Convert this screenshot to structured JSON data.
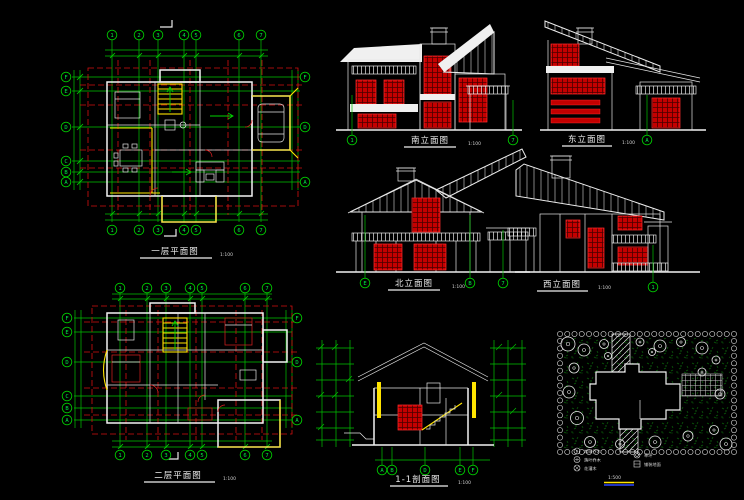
{
  "drawing": {
    "background": "#000000",
    "palette": {
      "grid_green": "#00cc00",
      "bubble_green": "#00ee44",
      "dashed_red": "#d51111",
      "window_red": "#c80000",
      "wall_white": "#f2f2f2",
      "accent_yellow": "#ffe400",
      "vegetation_green": "#0a5a0a",
      "scalebar_blue": "#2b46ff"
    }
  },
  "plan1": {
    "title": "一层平面图",
    "scale": "1:100",
    "bubbles_top": [
      "1",
      "2",
      "3",
      "4",
      "5",
      "6",
      "7"
    ],
    "bubbles_bottom": [
      "1",
      "2",
      "3",
      "4",
      "5",
      "6",
      "7"
    ],
    "bubbles_left": [
      "F",
      "E",
      "D",
      "C",
      "B",
      "A"
    ],
    "bubbles_right": [
      "F",
      "D",
      "A"
    ]
  },
  "plan2": {
    "title": "二层平面图",
    "scale": "1:100",
    "bubbles_top": [
      "1",
      "2",
      "3",
      "4",
      "5",
      "6",
      "7"
    ],
    "bubbles_bottom": [
      "1",
      "2",
      "3",
      "4",
      "5",
      "6",
      "7"
    ],
    "bubbles_left": [
      "F",
      "E",
      "D",
      "C",
      "B",
      "A"
    ],
    "bubbles_right": [
      "F",
      "D",
      "A"
    ]
  },
  "elev_south": {
    "title": "南立面图",
    "scale": "1:100",
    "bubbles": [
      "1",
      "7"
    ]
  },
  "elev_east": {
    "title": "东立面图",
    "scale": "1:100",
    "bubbles": [
      "A"
    ]
  },
  "elev_north": {
    "title": "北立面图",
    "scale": "1:100",
    "bubbles": [
      "E",
      "B",
      "7"
    ]
  },
  "elev_west": {
    "title": "西立面图",
    "scale": "1:100",
    "bubbles": [
      "1"
    ]
  },
  "section": {
    "title": "1-1剖面图",
    "scale": "1:100",
    "bubbles": [
      "A",
      "B",
      "D",
      "E",
      "F"
    ]
  },
  "site": {
    "scale": "1:500",
    "legend": [
      "常绿乔木",
      "落叶乔木",
      "花灌木",
      "草坪",
      "铺装地面"
    ]
  }
}
